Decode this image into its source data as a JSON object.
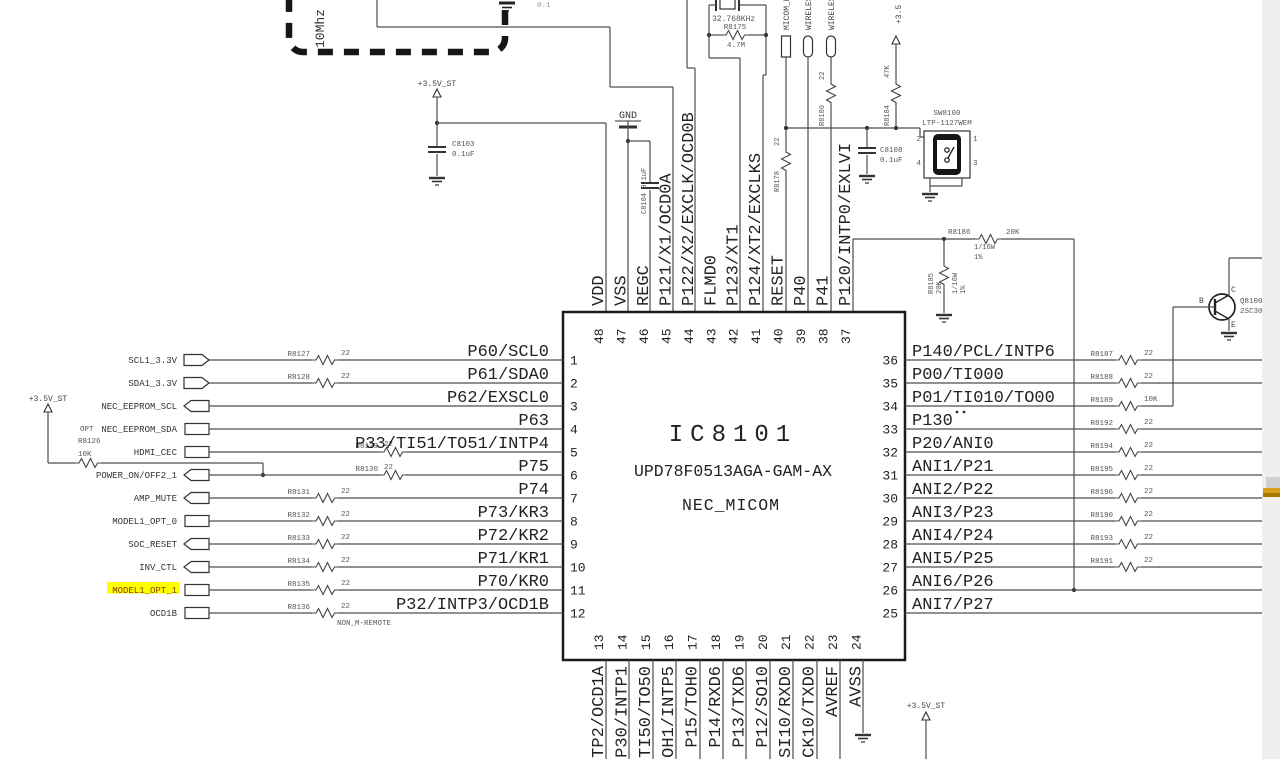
{
  "ic": {
    "ref": "IC8101",
    "part": "UPD78F0513AGA-GAM-AX",
    "name": "NEC_MICOM"
  },
  "pins": {
    "left": [
      {
        "num": "1",
        "name": "P60/SCL0",
        "net": "SCL1_3.3V",
        "res": {
          "ref": "R8127",
          "val": "22"
        }
      },
      {
        "num": "2",
        "name": "P61/SDA0",
        "net": "SDA1_3.3V",
        "res": {
          "ref": "R8128",
          "val": "22"
        }
      },
      {
        "num": "3",
        "name": "P62/EXSCL0",
        "net": "NEC_EEPROM_SCL"
      },
      {
        "num": "4",
        "name": "P63",
        "net": "NEC_EEPROM_SDA"
      },
      {
        "num": "5",
        "name": "P33/TI51/TO51/INTP4",
        "net": "HDMI_CEC",
        "res": {
          "ref": "R8129",
          "val": "22"
        }
      },
      {
        "num": "6",
        "name": "P75",
        "net": "POWER_ON/OFF2_1",
        "res": {
          "ref": "R8130",
          "val": "22"
        }
      },
      {
        "num": "7",
        "name": "P74",
        "net": "AMP_MUTE",
        "res": {
          "ref": "R8131",
          "val": "22"
        }
      },
      {
        "num": "8",
        "name": "P73/KR3",
        "net": "MODEL1_OPT_0",
        "res": {
          "ref": "R8132",
          "val": "22"
        }
      },
      {
        "num": "9",
        "name": "P72/KR2",
        "net": "SOC_RESET",
        "res": {
          "ref": "R8133",
          "val": "22"
        }
      },
      {
        "num": "10",
        "name": "P71/KR1",
        "net": "INV_CTL",
        "res": {
          "ref": "R8134",
          "val": "22"
        }
      },
      {
        "num": "11",
        "name": "P70/KR0",
        "net": "MODEL1_OPT_1",
        "res": {
          "ref": "R8135",
          "val": "22"
        }
      },
      {
        "num": "12",
        "name": "P32/INTP3/OCD1B",
        "net": "OCD1B",
        "res": {
          "ref": "R8136",
          "val": "22"
        }
      }
    ],
    "right": [
      {
        "num": "36",
        "name": "P140/PCL/INTP6",
        "res": {
          "ref": "R8187",
          "val": "22"
        }
      },
      {
        "num": "35",
        "name": "P00/TI000",
        "res": {
          "ref": "R8188",
          "val": "22"
        }
      },
      {
        "num": "34",
        "name": "P01/TI010/TO00",
        "res": {
          "ref": "R8189",
          "val": "10K"
        }
      },
      {
        "num": "33",
        "name": "P130",
        "res": {
          "ref": "R8192",
          "val": "22"
        }
      },
      {
        "num": "32",
        "name": "P20/ANI0",
        "res": {
          "ref": "R8194",
          "val": "22"
        }
      },
      {
        "num": "31",
        "name": "ANI1/P21",
        "res": {
          "ref": "R8195",
          "val": "22"
        }
      },
      {
        "num": "30",
        "name": "ANI2/P22",
        "res": {
          "ref": "R8196",
          "val": "22"
        }
      },
      {
        "num": "29",
        "name": "ANI3/P23",
        "res": {
          "ref": "R8190",
          "val": "22"
        }
      },
      {
        "num": "28",
        "name": "ANI4/P24",
        "res": {
          "ref": "R8193",
          "val": "22"
        }
      },
      {
        "num": "27",
        "name": "ANI5/P25",
        "res": {
          "ref": "R8191",
          "val": "22"
        }
      },
      {
        "num": "26",
        "name": "ANI6/P26"
      },
      {
        "num": "25",
        "name": "ANI7/P27"
      }
    ],
    "top": [
      {
        "num": "48",
        "name": "VDD"
      },
      {
        "num": "47",
        "name": "VSS"
      },
      {
        "num": "46",
        "name": "REGC"
      },
      {
        "num": "45",
        "name": "P121/X1/OCD0A"
      },
      {
        "num": "44",
        "name": "P122/X2/EXCLK/OCD0B"
      },
      {
        "num": "43",
        "name": "FLMD0"
      },
      {
        "num": "42",
        "name": "P123/XT1"
      },
      {
        "num": "41",
        "name": "P124/XT2/EXCLKS"
      },
      {
        "num": "40",
        "name": "RESET"
      },
      {
        "num": "39",
        "name": "P40"
      },
      {
        "num": "38",
        "name": "P41"
      },
      {
        "num": "37",
        "name": "P120/INTP0/EXLVI"
      }
    ],
    "bottom": [
      {
        "num": "13",
        "name": "TP2/OCD1A"
      },
      {
        "num": "14",
        "name": "P30/INTP1"
      },
      {
        "num": "15",
        "name": "TI50/TO50"
      },
      {
        "num": "16",
        "name": "OH1/INTP5"
      },
      {
        "num": "17",
        "name": "P15/TOH0"
      },
      {
        "num": "18",
        "name": "P14/RXD6"
      },
      {
        "num": "19",
        "name": "P13/TXD6"
      },
      {
        "num": "20",
        "name": "P12/SO10"
      },
      {
        "num": "21",
        "name": "SI10/RXD0"
      },
      {
        "num": "22",
        "name": "CK10/TXD0"
      },
      {
        "num": "23",
        "name": "AVREF"
      },
      {
        "num": "24",
        "name": "AVSS"
      }
    ]
  },
  "components": {
    "c8103": {
      "ref": "C8103",
      "val": "0.1uF"
    },
    "c8104": {
      "label": "C8104  0.1uF"
    },
    "c8108": {
      "ref": "C8108",
      "val": "0.1uF"
    },
    "xtal": {
      "freq": "32.768KHz"
    },
    "r8175": {
      "ref": "R8175",
      "val": "4.7M"
    },
    "r8178": {
      "ref": "R8178",
      "val": "22"
    },
    "r8180": {
      "ref": "R8180",
      "val": "22"
    },
    "r8184": {
      "ref": "R8184",
      "val": "47K"
    },
    "r8126": {
      "note": "OPT",
      "ref": "R8126",
      "val": "10K"
    },
    "r8186": {
      "ref": "R8186",
      "val": "20K",
      "watt": "1/16W",
      "tol": "1%"
    },
    "r8185": {
      "ref": "R8185",
      "val": "20K",
      "watt": "1/16W",
      "tol": "1%"
    },
    "sw8100": {
      "ref": "SW8100",
      "part": "LTP-1127WEM",
      "p1": "1",
      "p2": "2",
      "p3": "3",
      "p4": "4"
    },
    "q8100": {
      "ref": "Q8100",
      "part": "2SC30",
      "b": "B",
      "c": "C",
      "e": "E"
    }
  },
  "power": {
    "plus35_left": "+3.5V_ST",
    "plus35_mid": "+3.5V_ST",
    "plus35_top": "+3.5",
    "plus35_bottom": "+3.5V_ST",
    "gnd": "GND"
  },
  "flags_top": [
    {
      "label": "MICOM_R"
    },
    {
      "label": "WIRELES"
    },
    {
      "label": "WIRELES"
    }
  ],
  "texts": {
    "osc_freq": "10Mhz",
    "non_m_remote": "NON_M-REMOTE",
    "cap_frag": "0.1"
  },
  "colors": {
    "wire": "#4d4d4d",
    "text_dark": "#222222",
    "text_small": "#555555",
    "highlight_bg": "#ffff00",
    "highlight_text": "#8b4000",
    "edge_strip": "#f0efee",
    "accent_gold": "#d4a017",
    "accent_gold_dark": "#a87900",
    "accent_gray": "#cfcfcd"
  }
}
